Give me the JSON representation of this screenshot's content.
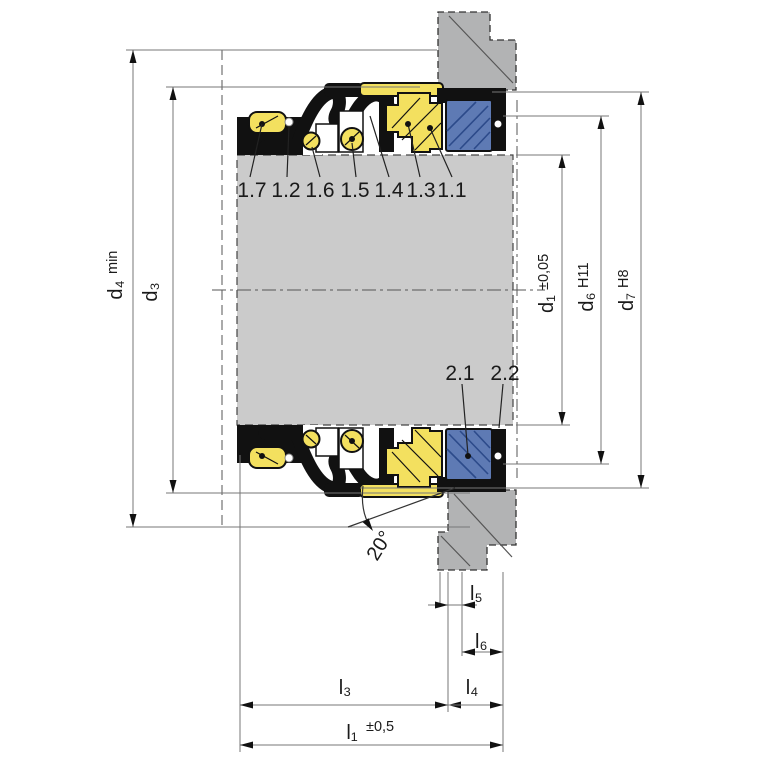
{
  "callouts": {
    "rotating": [
      "1.7",
      "1.2",
      "1.6",
      "1.5",
      "1.4",
      "1.3",
      "1.1"
    ],
    "stationary": [
      "2.1",
      "2.2"
    ]
  },
  "dimensions": {
    "d4": {
      "label": "d₄",
      "qualifier": "min"
    },
    "d3": {
      "label": "d₃",
      "qualifier": ""
    },
    "d1": {
      "label": "d₁",
      "qualifier": "±0,05"
    },
    "d6": {
      "label": "d₆",
      "qualifier": "H11"
    },
    "d7": {
      "label": "d₇",
      "qualifier": "H8"
    },
    "l1": {
      "label": "l₁",
      "qualifier": "±0,5"
    },
    "l3": {
      "label": "l₃"
    },
    "l4": {
      "label": "l₄"
    },
    "l5": {
      "label": "l₅"
    },
    "l6": {
      "label": "l₆"
    }
  },
  "angle": {
    "label": "20°"
  },
  "colors": {
    "elastomer_yellow": "#f3e05f",
    "seat_blue": "#5e7ab4",
    "shaft_gray": "#cbcbcb",
    "housing_gray": "#b2b3b4",
    "bellows_black": "#111111"
  }
}
